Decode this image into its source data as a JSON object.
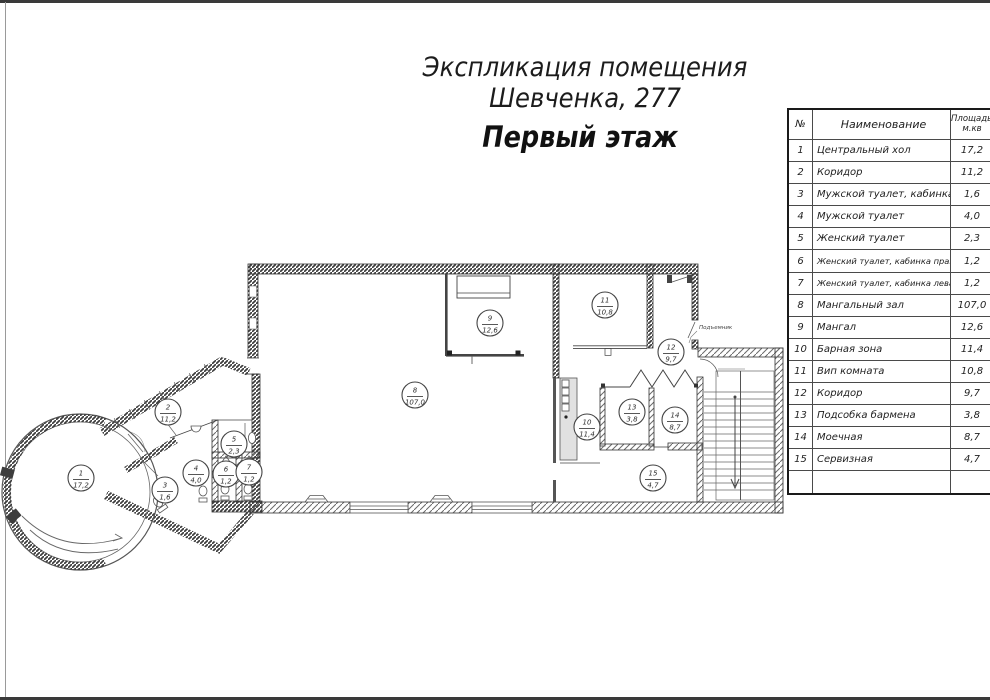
{
  "title": "Экспликация помещения Шевченка, 277",
  "subtitle": "Первый этаж",
  "table": {
    "headers": {
      "num": "№",
      "name": "Наименование",
      "area": "Площадь, м.кв"
    },
    "rows": [
      {
        "num": "1",
        "name": "Центральный хол",
        "area": "17,2"
      },
      {
        "num": "2",
        "name": "Коридор",
        "area": "11,2"
      },
      {
        "num": "3",
        "name": "Мужской туалет, кабинка",
        "area": "1,6"
      },
      {
        "num": "4",
        "name": "Мужской туалет",
        "area": "4,0"
      },
      {
        "num": "5",
        "name": "Женский туалет",
        "area": "2,3"
      },
      {
        "num": "6",
        "name": "Женский туалет, кабинка правая",
        "area": "1,2"
      },
      {
        "num": "7",
        "name": "Женский туалет, кабинка левая",
        "area": "1,2"
      },
      {
        "num": "8",
        "name": "Мангальный зал",
        "area": "107,0"
      },
      {
        "num": "9",
        "name": "Мангал",
        "area": "12,6"
      },
      {
        "num": "10",
        "name": "Барная зона",
        "area": "11,4"
      },
      {
        "num": "11",
        "name": "Вип комната",
        "area": "10,8"
      },
      {
        "num": "12",
        "name": "Коридор",
        "area": "9,7"
      },
      {
        "num": "13",
        "name": "Подсобка бармена",
        "area": "3,8"
      },
      {
        "num": "14",
        "name": "Моечная",
        "area": "8,7"
      },
      {
        "num": "15",
        "name": "Сервизная",
        "area": "4,7"
      },
      {
        "num": "",
        "name": "",
        "area": ""
      }
    ]
  },
  "plan": {
    "room_labels": [
      {
        "number": "1",
        "area": "17,2",
        "x": 81,
        "y": 478
      },
      {
        "number": "2",
        "area": "11,2",
        "x": 168,
        "y": 412
      },
      {
        "number": "3",
        "area": "1,6",
        "x": 165,
        "y": 490
      },
      {
        "number": "4",
        "area": "4,0",
        "x": 196,
        "y": 473
      },
      {
        "number": "5",
        "area": "2,3",
        "x": 234,
        "y": 444
      },
      {
        "number": "6",
        "area": "1,2",
        "x": 226,
        "y": 474
      },
      {
        "number": "7",
        "area": "1,2",
        "x": 249,
        "y": 472
      },
      {
        "number": "8",
        "area": "107,0",
        "x": 415,
        "y": 395
      },
      {
        "number": "9",
        "area": "12,6",
        "x": 490,
        "y": 323
      },
      {
        "number": "10",
        "area": "11,4",
        "x": 587,
        "y": 427
      },
      {
        "number": "11",
        "area": "10,8",
        "x": 605,
        "y": 305
      },
      {
        "number": "12",
        "area": "9,7",
        "x": 671,
        "y": 352
      },
      {
        "number": "13",
        "area": "3,8",
        "x": 632,
        "y": 412
      },
      {
        "number": "14",
        "area": "8,7",
        "x": 675,
        "y": 420
      },
      {
        "number": "15",
        "area": "4,7",
        "x": 653,
        "y": 478
      }
    ],
    "annotations": [
      {
        "text": "Подъемник",
        "x": 699,
        "y": 329
      }
    ]
  }
}
